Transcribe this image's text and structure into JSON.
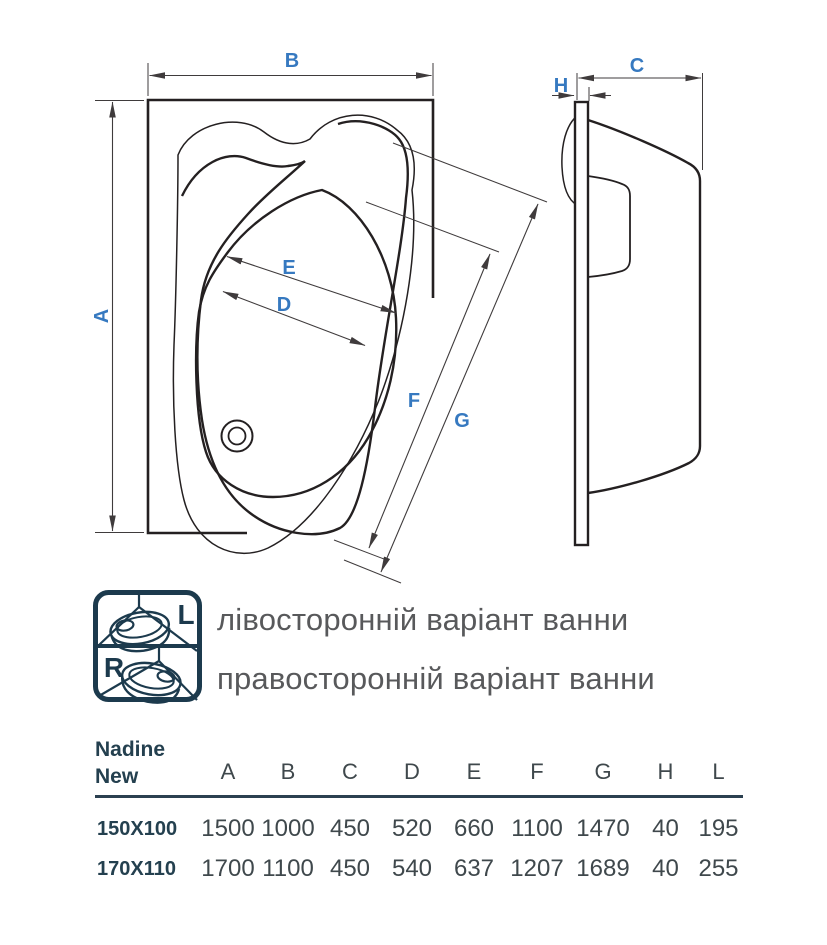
{
  "dims": {
    "a": "A",
    "b": "B",
    "c": "C",
    "d": "D",
    "e": "E",
    "f": "F",
    "g": "G",
    "h": "H"
  },
  "legend": {
    "left_letter": "L",
    "right_letter": "R",
    "left_text": "лівосторонній варіант ванни",
    "right_text": "правосторонній варіант ванни"
  },
  "table": {
    "title_line1": "Nadine",
    "title_line2": "New",
    "columns": [
      "A",
      "B",
      "C",
      "D",
      "E",
      "F",
      "G",
      "H",
      "L"
    ],
    "rows": [
      {
        "size": "150X100",
        "values": [
          "1500",
          "1000",
          "450",
          "520",
          "660",
          "1100",
          "1470",
          "40",
          "195"
        ]
      },
      {
        "size": "170X110",
        "values": [
          "1700",
          "1100",
          "450",
          "540",
          "637",
          "1207",
          "1689",
          "40",
          "255"
        ]
      }
    ]
  },
  "colors": {
    "accent_blue": "#3679c0",
    "navy": "#1c3a4d",
    "ink": "#242021",
    "legend_text_gray": "#58595b",
    "table_text": "#3f484c",
    "table_dark": "#24404f"
  }
}
